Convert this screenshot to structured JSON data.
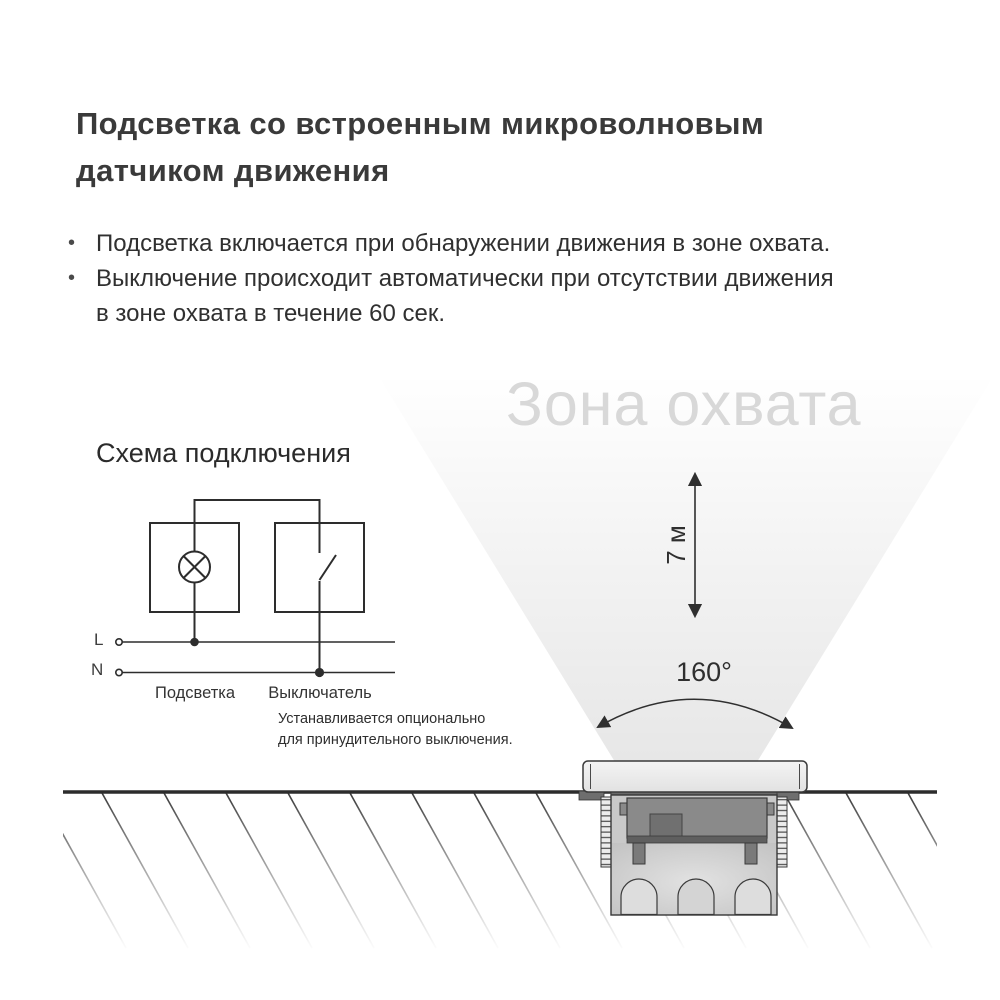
{
  "title": {
    "lines": [
      "Подсветка со встроенным микроволновым",
      "датчиком движения"
    ]
  },
  "bullets": [
    {
      "marker": "•",
      "lines": [
        "Подсветка включается при обнаружении движения в зоне охвата."
      ]
    },
    {
      "marker": "•",
      "lines": [
        "Выключение происходит автоматически при отсутствии движения",
        "в зоне охвата в течение 60 сек."
      ]
    }
  ],
  "wiring": {
    "title": "Схема подключения",
    "line_l_label": "L",
    "line_n_label": "N",
    "lamp_label": "Подсветка",
    "switch_label": "Выключатель",
    "note_lines": [
      "Устанавливается опционально",
      "для принудительного выключения."
    ]
  },
  "coverage": {
    "watermark": "Зона охвата",
    "range_label": "7 м",
    "angle_label": "160°"
  },
  "colors": {
    "page_bg": "#ffffff",
    "title_text": "#3a3a3a",
    "body_text": "#303030",
    "watermark_text": "#d8d8d8",
    "diagram_stroke": "#2d2d2d",
    "ground_line": "#2c2c2c",
    "beam_shade_max": "rgba(0,0,0,0.095)",
    "fixture_light_gray": "#e9e9e9",
    "fixture_mid_gray": "#c9c9c9",
    "fixture_dark_gray": "#8a8a8a"
  }
}
